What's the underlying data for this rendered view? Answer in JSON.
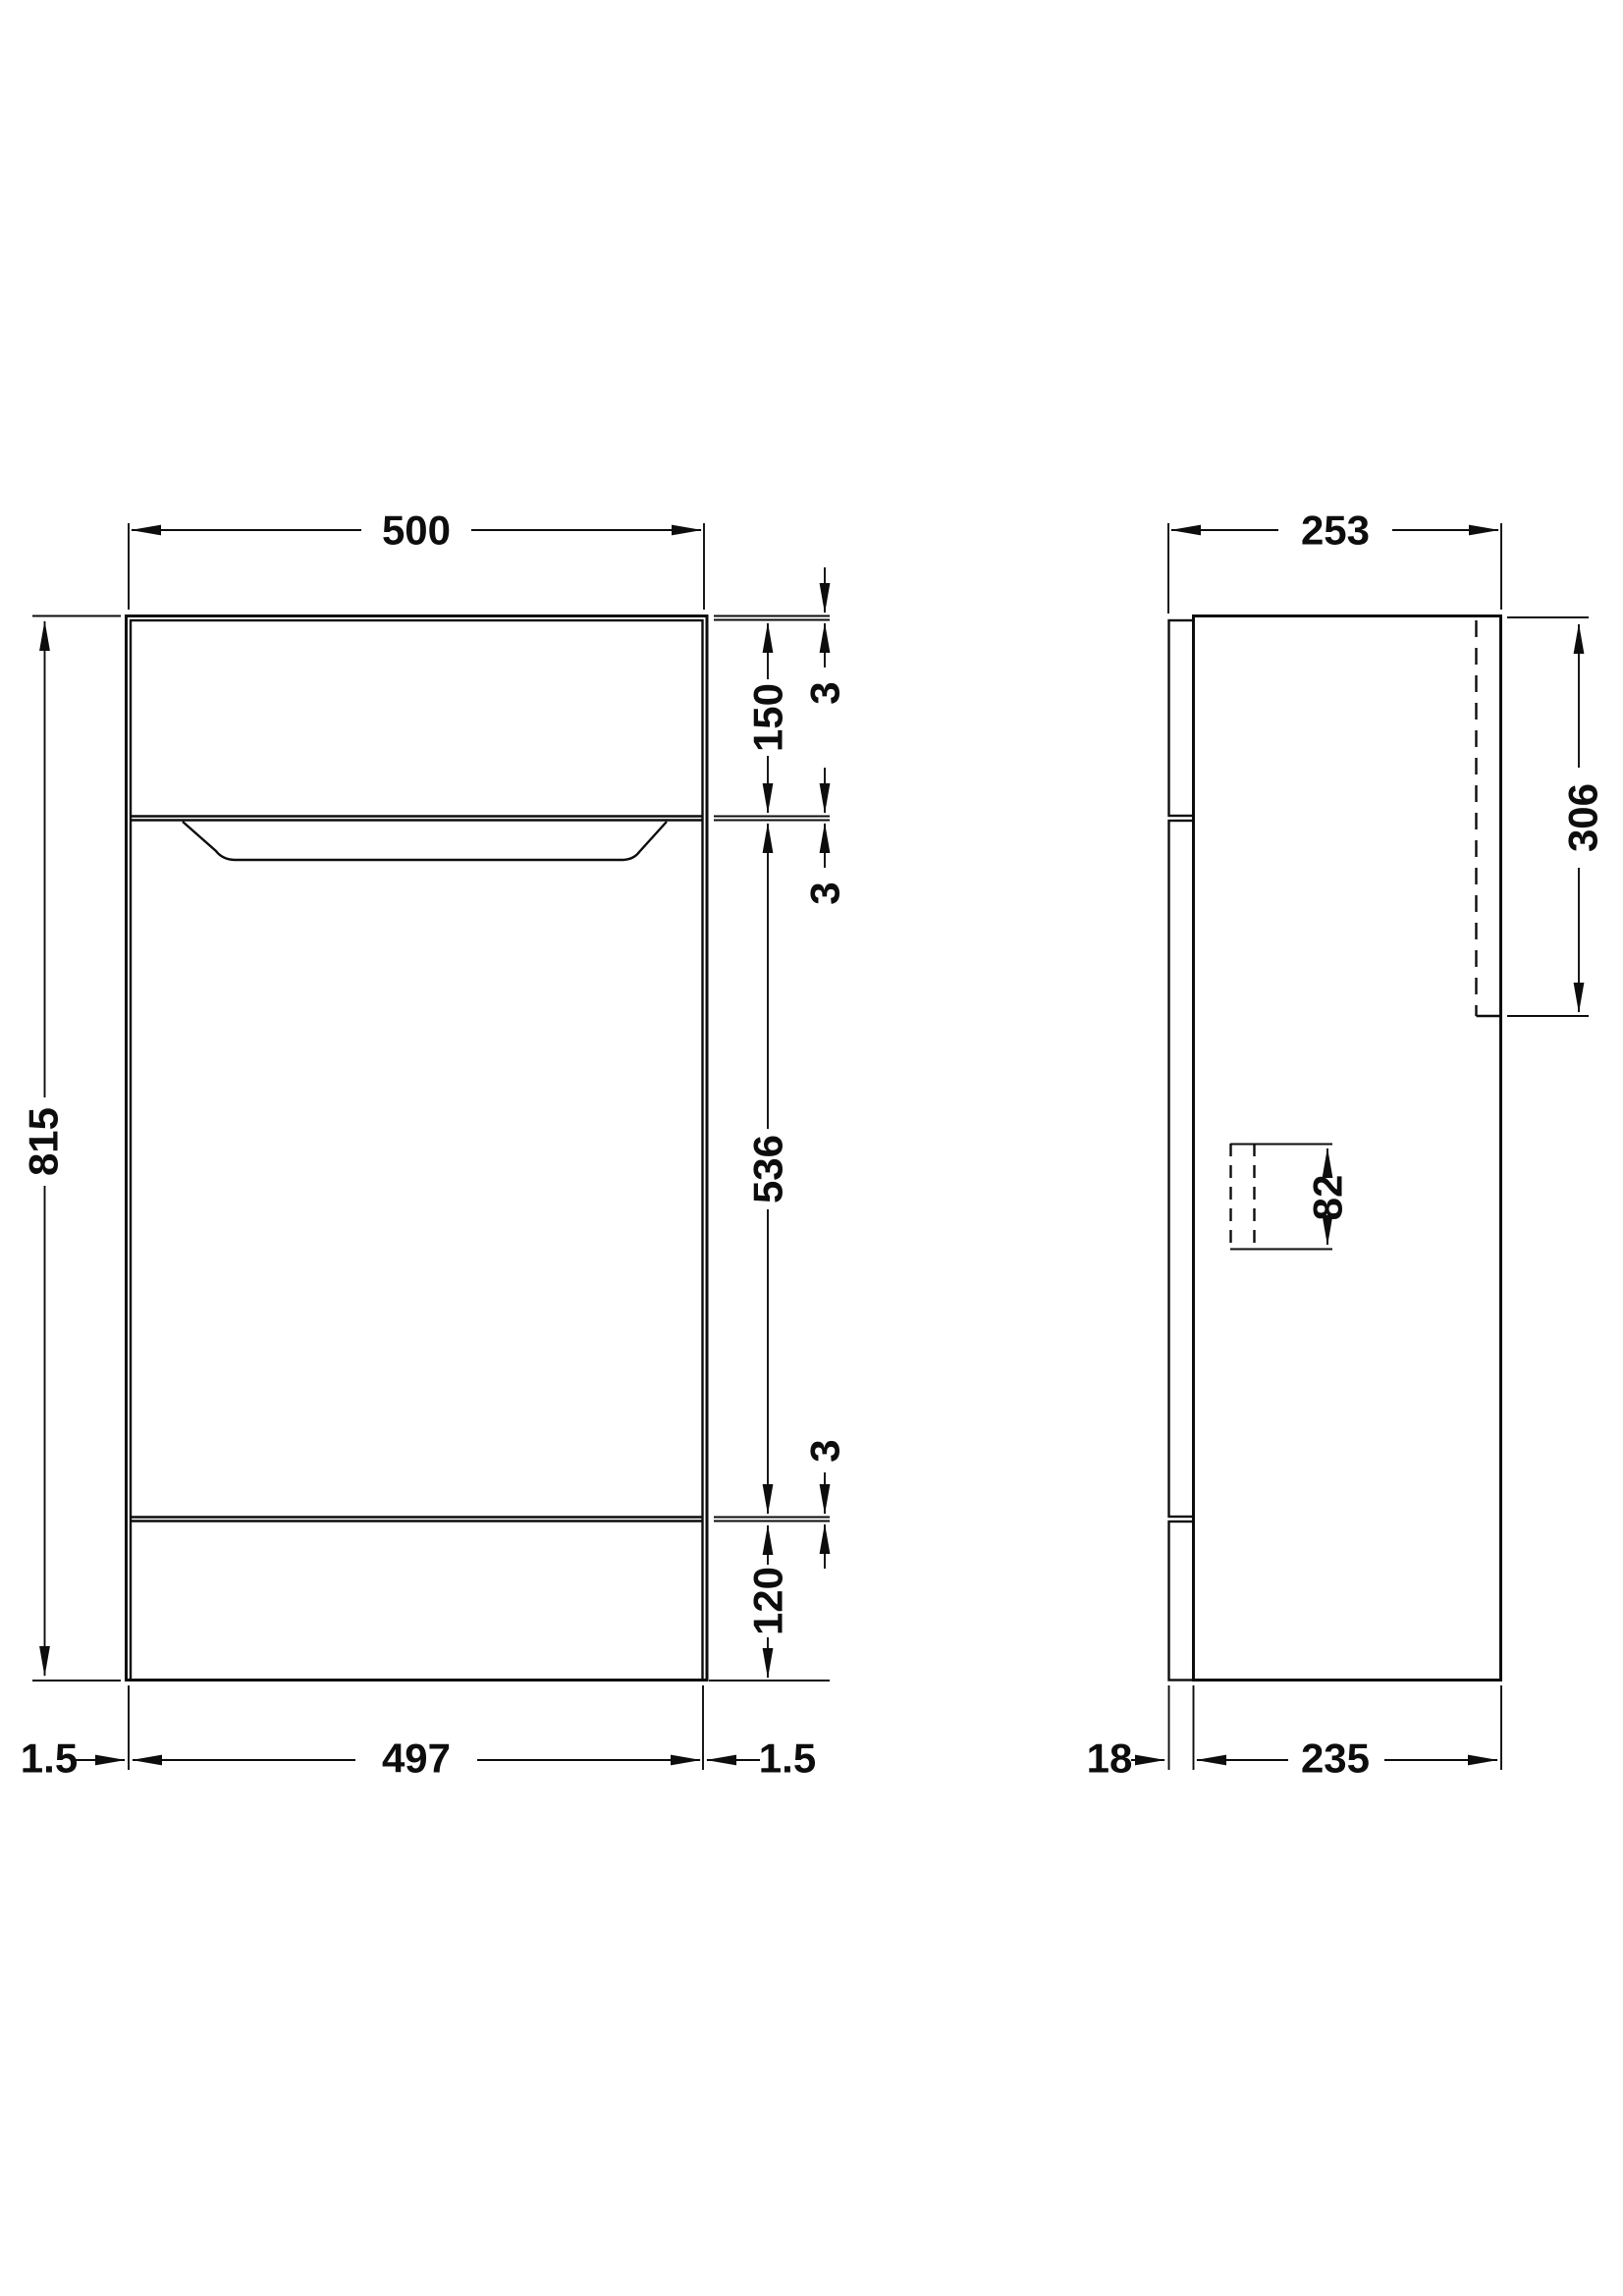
{
  "drawing_type": "technical-dimension-drawing",
  "colors": {
    "line": "#0d0d0d",
    "background": "#ffffff"
  },
  "front_view": {
    "overall_width": "500",
    "overall_height": "815",
    "drawer_front_height": "150",
    "top_gap": "3",
    "mid_gap": "3",
    "door_height": "536",
    "bottom_gap": "3",
    "plinth_height": "120",
    "left_margin": "1.5",
    "door_width": "497",
    "right_margin": "1.5"
  },
  "side_view": {
    "overall_depth": "253",
    "cistern_zone_height": "306",
    "fixing_zone_height": "82",
    "front_panel_thickness": "18",
    "carcass_depth": "235"
  }
}
